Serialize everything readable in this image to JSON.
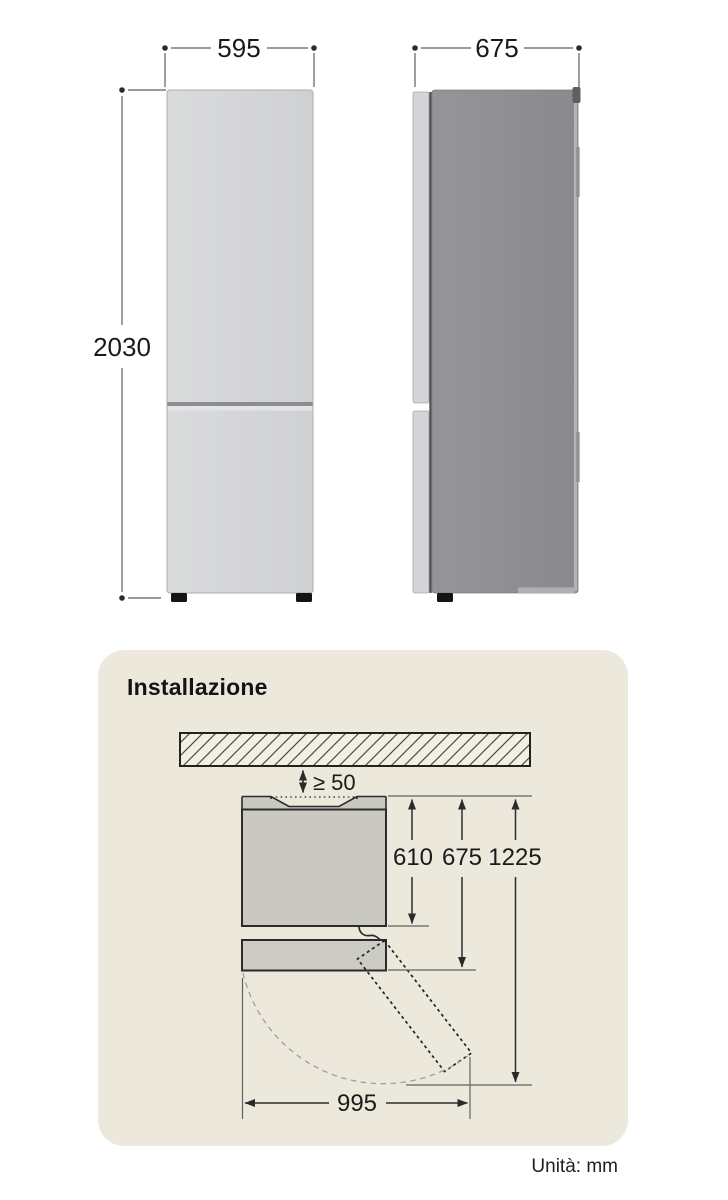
{
  "page": {
    "background": "#ffffff",
    "unit_note": "Unità: mm"
  },
  "dimensions": {
    "front_view": {
      "width": "595",
      "height": "2030"
    },
    "side_view": {
      "depth": "675"
    }
  },
  "installation": {
    "title": "Installazione",
    "panel_background": "#ece8dc",
    "top_clearance": "≥ 50",
    "body_depth": "610",
    "total_depth": "675",
    "door_open_depth": "1225",
    "door_open_width": "995"
  },
  "colors": {
    "outline_dark": "#2b2b2b",
    "dimension_line": "#2e2e2e",
    "fridge_front_fill": "#d5d6d8",
    "fridge_side_body_fill": "#8f9092",
    "fridge_side_door_fill": "#d3d4d6",
    "top_view_fill": "#c9c8c1",
    "feet_fill": "#141414",
    "swing_arc": "#a29f94"
  }
}
